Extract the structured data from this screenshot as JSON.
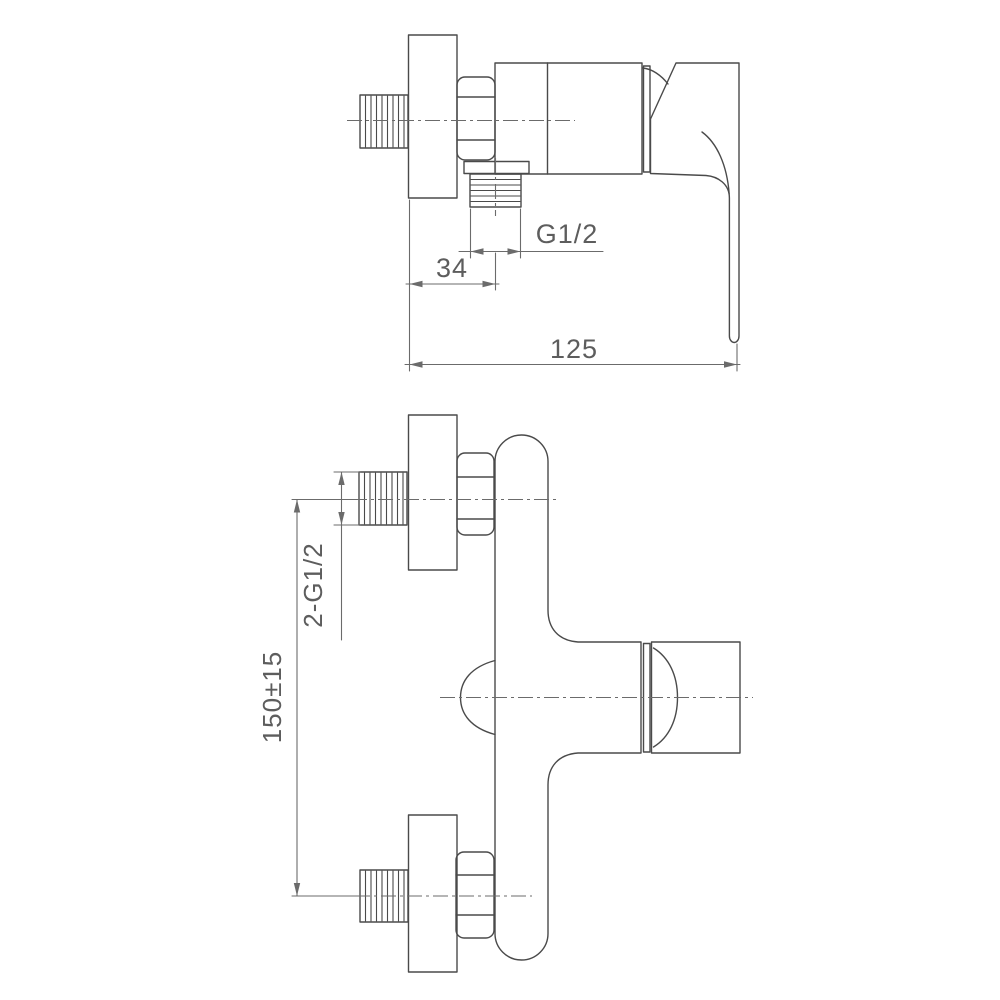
{
  "drawing": {
    "title": "Shower mixer tap technical drawing, two views",
    "background": "#ffffff",
    "line_color": "#4a4a4a",
    "dim_color": "#6b6b6b",
    "text_color": "#5d5d5d"
  },
  "views": {
    "side": {
      "name": "side-view",
      "dims": {
        "outlet_thread": "G1/2",
        "wall_to_outlet": "34",
        "overall_depth": "125"
      }
    },
    "front": {
      "name": "front-view",
      "dims": {
        "inlet_threads": "2-G1/2",
        "inlet_spacing": "150±15"
      }
    }
  }
}
